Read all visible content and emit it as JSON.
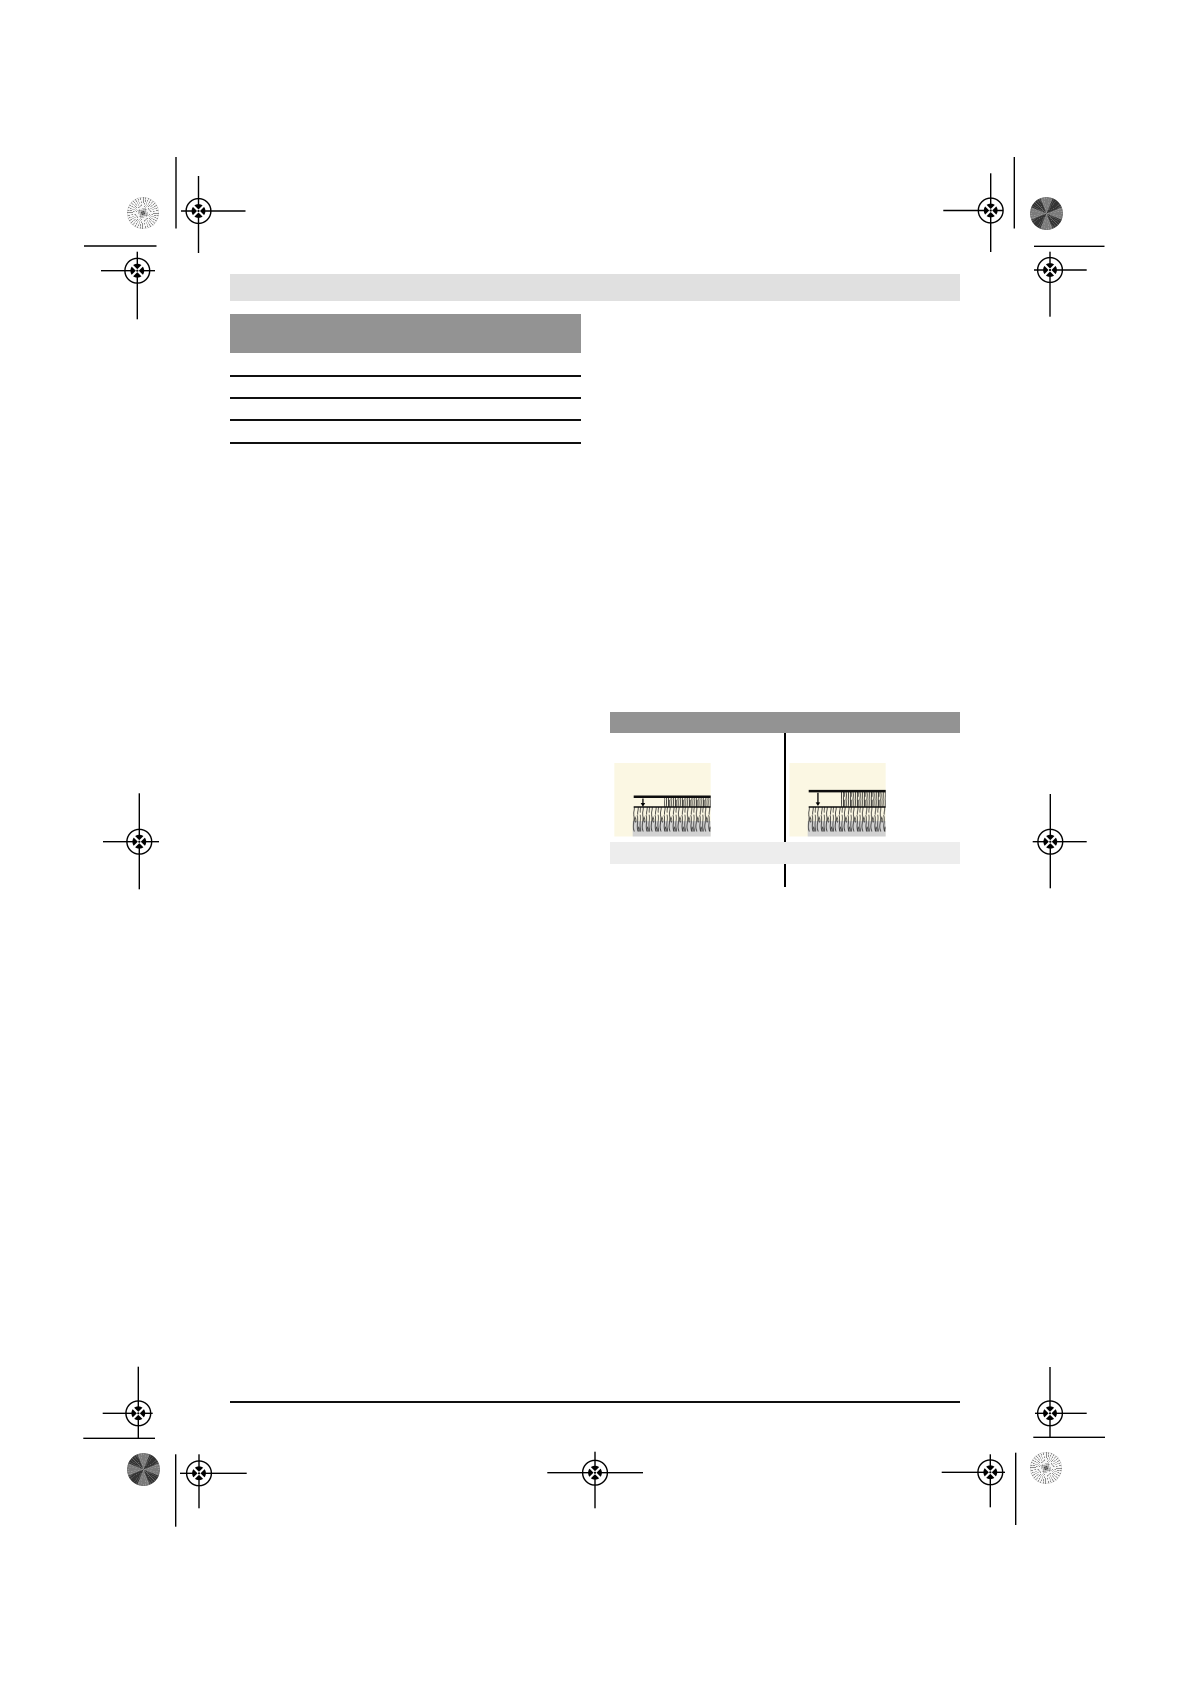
{
  "document": {
    "kind": "prepress-manual-page",
    "visible_text": [],
    "page_background": "#ffffff"
  },
  "colors": {
    "page_header_strip": "#e0e0e0",
    "section_heading_bar": "#939393",
    "tips_table_header_bar": "#939393",
    "tips_caption_row": "#ededed",
    "content_rules": "#101010",
    "figure_background": "#fbf7e3",
    "figure_soil": "#d2d2d2",
    "grass_stroke": "#1b1b1b",
    "registration_marks": "#000000"
  },
  "left_section": {
    "heading_bar_text": "",
    "ruled_lines_count": 4
  },
  "tips_table": {
    "header_text": "",
    "caption_text": "",
    "column_count": 2,
    "cells": [
      {
        "figure": "grass-cut-height-shallow",
        "arrow_depth": "small"
      },
      {
        "figure": "grass-cut-height-deep",
        "arrow_depth": "large"
      }
    ]
  },
  "print_marks": {
    "crosshair_targets": 11,
    "calibration_disks": [
      {
        "corner": "top-left",
        "style": "light-starburst"
      },
      {
        "corner": "top-right",
        "style": "dark-starburst"
      },
      {
        "corner": "bottom-left",
        "style": "dark-starburst"
      },
      {
        "corner": "bottom-right",
        "style": "light-starburst"
      }
    ],
    "short_trim_lines": 4,
    "footer_rule": true
  }
}
